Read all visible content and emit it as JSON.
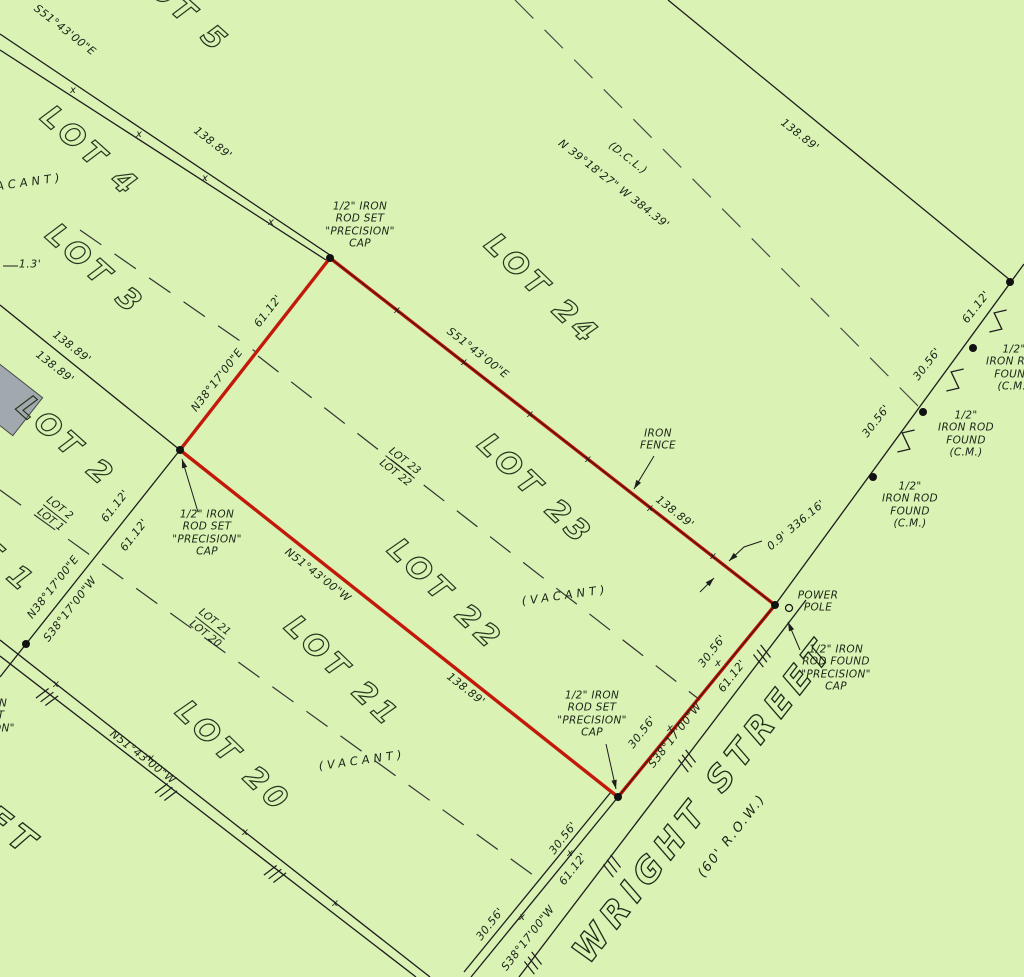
{
  "app": {
    "type": "survey-plat-drawing",
    "background_color": "#daf2b4",
    "line_color": "#1d1d1d",
    "red_color": "#c2190b",
    "building_fill": "#a2a9ae"
  },
  "parcel": {
    "description": "red outlined parcel covering LOT 22 and LOT 23",
    "outline_color": "#c2190b",
    "corners": [
      [
        330,
        258
      ],
      [
        775,
        605
      ],
      [
        618,
        797
      ],
      [
        180,
        450
      ]
    ]
  },
  "lot_labels_large": [
    {
      "text": "LOT 5",
      "x": 180,
      "y": 8,
      "rot": 42
    },
    {
      "text": "LOT 4",
      "x": 90,
      "y": 152,
      "rot": 42
    },
    {
      "text": "LOT 3",
      "x": 95,
      "y": 270,
      "rot": 42
    },
    {
      "text": "LOT 2",
      "x": 66,
      "y": 442,
      "rot": 42
    },
    {
      "text": "LOT 1",
      "x": -14,
      "y": 548,
      "rot": 42
    },
    {
      "text": "LOT 24",
      "x": 542,
      "y": 290,
      "rot": 44
    },
    {
      "text": "LOT 23",
      "x": 535,
      "y": 490,
      "rot": 44
    },
    {
      "text": "LOT 22",
      "x": 445,
      "y": 595,
      "rot": 44
    },
    {
      "text": "LOT 21",
      "x": 342,
      "y": 672,
      "rot": 44
    },
    {
      "text": "LOT 20",
      "x": 233,
      "y": 757,
      "rot": 44
    }
  ],
  "street_labels": [
    {
      "text": "WRIGHT  STREET",
      "x": 704,
      "y": 800,
      "rot": -52,
      "cls": "street"
    },
    {
      "text": "(60' R.O.W.)",
      "x": 732,
      "y": 836,
      "rot": -52,
      "cls": "row"
    },
    {
      "text": "FT",
      "x": 12,
      "y": 832,
      "rot": 38,
      "cls": "street"
    }
  ],
  "vacant_labels": [
    {
      "text": "(VACANT)",
      "x": 20,
      "y": 183,
      "rot": -8
    },
    {
      "text": "(VACANT)",
      "x": 565,
      "y": 595,
      "rot": -8
    },
    {
      "text": "(VACANT)",
      "x": 362,
      "y": 760,
      "rot": -8
    }
  ],
  "lot_fraction_labels": [
    {
      "top": "LOT 23",
      "bottom": "LOT 22",
      "x": 400,
      "y": 467,
      "rot": 38
    },
    {
      "top": "LOT 21",
      "bottom": "LOT 20",
      "x": 210,
      "y": 628,
      "rot": 38
    },
    {
      "top": "LOT 2",
      "bottom": "LOT 1",
      "x": 55,
      "y": 514,
      "rot": 38
    }
  ],
  "dimension_labels": [
    {
      "text": "S51°43'00\"E",
      "x": 65,
      "y": 30,
      "rot": 38
    },
    {
      "text": "138.89'",
      "x": 213,
      "y": 143,
      "rot": 38
    },
    {
      "text": "S51°43'00\"E",
      "x": 478,
      "y": 353,
      "rot": 38
    },
    {
      "text": "138.89'",
      "x": 675,
      "y": 512,
      "rot": 38
    },
    {
      "text": "138.89'",
      "x": 800,
      "y": 135,
      "rot": 38
    },
    {
      "text": "138.89'",
      "x": 72,
      "y": 347,
      "rot": 38
    },
    {
      "text": "138.89'",
      "x": 55,
      "y": 367,
      "rot": 38
    },
    {
      "text": "N51°43'00\"W",
      "x": 318,
      "y": 575,
      "rot": 38
    },
    {
      "text": "138.89'",
      "x": 466,
      "y": 689,
      "rot": 38
    },
    {
      "text": "N51°43'00\"W",
      "x": 143,
      "y": 757,
      "rot": 38
    },
    {
      "text": "(D.C.L.)",
      "x": 628,
      "y": 158,
      "rot": 38
    },
    {
      "text": "N 39°18'27\" W  384.39'",
      "x": 614,
      "y": 184,
      "rot": 38
    },
    {
      "text": "N38°17'00\"E",
      "x": 217,
      "y": 380,
      "rot": -52
    },
    {
      "text": "61.12'",
      "x": 268,
      "y": 311,
      "rot": -52
    },
    {
      "text": "61.12'",
      "x": 115,
      "y": 506,
      "rot": -52
    },
    {
      "text": "61.12'",
      "x": 134,
      "y": 535,
      "rot": -52
    },
    {
      "text": "N38°17'00\"E",
      "x": 53,
      "y": 587,
      "rot": -52
    },
    {
      "text": "S38°17'00\"W",
      "x": 70,
      "y": 609,
      "rot": -52
    },
    {
      "text": "30.56'",
      "x": 712,
      "y": 651,
      "rot": -52
    },
    {
      "text": "61.12'",
      "x": 732,
      "y": 676,
      "rot": -52
    },
    {
      "text": "S38°17'00\"W",
      "x": 675,
      "y": 735,
      "rot": -52
    },
    {
      "text": "30.56'",
      "x": 642,
      "y": 732,
      "rot": -52
    },
    {
      "text": "30.56'",
      "x": 563,
      "y": 838,
      "rot": -52
    },
    {
      "text": "61.12'",
      "x": 573,
      "y": 869,
      "rot": -52
    },
    {
      "text": "30.56'",
      "x": 490,
      "y": 924,
      "rot": -52
    },
    {
      "text": "S38°17'00\"W",
      "x": 528,
      "y": 938,
      "rot": -52
    },
    {
      "text": "30.56'",
      "x": 876,
      "y": 421,
      "rot": -52
    },
    {
      "text": "30.56'",
      "x": 927,
      "y": 364,
      "rot": -52
    },
    {
      "text": "61.12'",
      "x": 976,
      "y": 307,
      "rot": -52
    },
    {
      "text": "0.9' 336.16'",
      "x": 796,
      "y": 525,
      "rot": -40
    },
    {
      "text": "1.3'",
      "x": 30,
      "y": 264,
      "rot": 0
    }
  ],
  "note_blocks": [
    {
      "name": "iron-rod-set-top",
      "lines": [
        "1/2\" IRON",
        "ROD SET",
        "\"PRECISION\"",
        "CAP"
      ],
      "x": 360,
      "y": 225
    },
    {
      "name": "iron-rod-set-left",
      "lines": [
        "1/2\" IRON",
        "ROD SET",
        "\"PRECISION\"",
        "CAP"
      ],
      "x": 207,
      "y": 533
    },
    {
      "name": "iron-rod-set-bottom",
      "lines": [
        "1/2\" IRON",
        "ROD SET",
        "\"PRECISION\"",
        "CAP"
      ],
      "x": 592,
      "y": 714
    },
    {
      "name": "iron-rod-set-edge",
      "lines": [
        "1/2\" IRON",
        "ROD SET",
        "\"PRECISION\"",
        "CAP"
      ],
      "x": -20,
      "y": 722
    },
    {
      "name": "iron-rod-found-pole",
      "lines": [
        "1/2\" IRON",
        "ROD FOUND",
        "\"PRECISION\"",
        "CAP"
      ],
      "x": 836,
      "y": 668
    },
    {
      "name": "iron-rod-found-1",
      "lines": [
        "1/2\"",
        "IRON ROD",
        "FOUND",
        "(C.M.)"
      ],
      "x": 910,
      "y": 505
    },
    {
      "name": "iron-rod-found-2",
      "lines": [
        "1/2\"",
        "IRON ROD",
        "FOUND",
        "(C.M.)"
      ],
      "x": 966,
      "y": 434
    },
    {
      "name": "iron-rod-found-3",
      "lines": [
        "1/2\"",
        "IRON ROD",
        "FOUND",
        "(C.M.)"
      ],
      "x": 1014,
      "y": 368
    },
    {
      "name": "power-pole",
      "lines": [
        "POWER",
        "POLE"
      ],
      "x": 818,
      "y": 602
    },
    {
      "name": "iron-fence",
      "lines": [
        "IRON",
        "FENCE"
      ],
      "x": 658,
      "y": 440
    }
  ],
  "geometry": {
    "solid_lines": [
      {
        "name": "lot5-lot4-fence-a",
        "pts": [
          [
            0,
            34
          ],
          [
            330,
            255
          ]
        ]
      },
      {
        "name": "lot5-lot4-fence-b",
        "pts": [
          [
            0,
            50
          ],
          [
            326,
            260
          ]
        ]
      },
      {
        "name": "lot3-lot2-line",
        "pts": [
          [
            0,
            305
          ],
          [
            180,
            450
          ]
        ]
      },
      {
        "name": "lot24-lot25-line",
        "pts": [
          [
            668,
            0
          ],
          [
            1010,
            280
          ]
        ]
      },
      {
        "name": "street-row-line-ne",
        "pts": [
          [
            775,
            605
          ],
          [
            1024,
            264
          ]
        ]
      },
      {
        "name": "street-row-line-sw-a",
        "pts": [
          [
            618,
            797
          ],
          [
            471,
            977
          ]
        ]
      },
      {
        "name": "street-row-line-sw-b",
        "pts": [
          [
            611,
            792
          ],
          [
            464,
            972
          ]
        ]
      },
      {
        "name": "street-edge-line",
        "pts": [
          [
            806,
            600
          ],
          [
            519,
            977
          ]
        ]
      },
      {
        "name": "rear-lot-line-sw",
        "pts": [
          [
            180,
            450
          ],
          [
            26,
            644
          ],
          [
            0,
            677
          ]
        ]
      },
      {
        "name": "block-end-fence-a",
        "pts": [
          [
            0,
            640
          ],
          [
            430,
            977
          ]
        ]
      },
      {
        "name": "block-end-fence-b",
        "pts": [
          [
            0,
            656
          ],
          [
            416,
            977
          ]
        ]
      }
    ],
    "dashed_lines": [
      {
        "name": "lot4-lot3-dashed",
        "pts": [
          [
            80,
            230
          ],
          [
            256,
            352
          ]
        ],
        "color": "#333333"
      },
      {
        "name": "lot23-lot22-dashed",
        "pts": [
          [
            258,
            356
          ],
          [
            700,
            700
          ]
        ],
        "color": "#333333"
      },
      {
        "name": "lot2-lot1-lot21-lot20-dashed",
        "pts": [
          [
            0,
            490
          ],
          [
            540,
            880
          ]
        ],
        "color": "#333333"
      },
      {
        "name": "deed-call-line-dashed",
        "pts": [
          [
            515,
            0
          ],
          [
            924,
            412
          ]
        ],
        "color": "#4a4a4a"
      }
    ],
    "fence_overlays": [
      {
        "name": "parcel-ne-fence",
        "pts": [
          [
            330,
            258
          ],
          [
            775,
            605
          ]
        ]
      },
      {
        "name": "parcel-se-fence",
        "pts": [
          [
            775,
            605
          ],
          [
            618,
            797
          ]
        ]
      }
    ],
    "fence_xticks": [
      [
        73,
        90
      ],
      [
        139,
        134
      ],
      [
        205,
        178
      ],
      [
        271,
        222
      ],
      [
        397,
        310
      ],
      [
        464,
        362
      ],
      [
        530,
        414
      ],
      [
        588,
        459
      ],
      [
        650,
        508
      ],
      [
        713,
        556
      ],
      [
        718,
        663
      ],
      [
        670,
        728
      ],
      [
        570,
        853
      ],
      [
        522,
        917
      ],
      [
        56,
        684
      ],
      [
        151,
        758
      ],
      [
        245,
        832
      ],
      [
        335,
        903
      ]
    ],
    "dots": [
      [
        330,
        258
      ],
      [
        180,
        450
      ],
      [
        618,
        797
      ],
      [
        775,
        605
      ],
      [
        873,
        477
      ],
      [
        923,
        412
      ],
      [
        973,
        348
      ],
      [
        1010,
        282
      ],
      [
        26,
        644
      ]
    ],
    "pole_circle": {
      "x": 789,
      "y": 608,
      "r": 3.5
    },
    "zigzag_breaks": [
      [
        906,
        441
      ],
      [
        955,
        380
      ],
      [
        998,
        321
      ]
    ],
    "witness_hashes": [
      {
        "x": 47,
        "y": 697,
        "a": 38
      },
      {
        "x": 166,
        "y": 792,
        "a": 38
      },
      {
        "x": 275,
        "y": 874,
        "a": 38
      },
      {
        "x": 612,
        "y": 866,
        "a": -53
      },
      {
        "x": 687,
        "y": 761,
        "a": -53
      },
      {
        "x": 533,
        "y": 963,
        "a": -53
      },
      {
        "x": 762,
        "y": 656,
        "a": -53
      }
    ],
    "leaders": [
      {
        "name": "iron-fence-leader",
        "pts": [
          [
            654,
            456
          ],
          [
            634,
            489
          ]
        ],
        "arrow": true
      },
      {
        "name": "offset-dim-leader-a",
        "pts": [
          [
            762,
            541
          ],
          [
            744,
            547
          ],
          [
            729,
            561
          ]
        ],
        "arrow": true
      },
      {
        "name": "offset-dim-leader-b",
        "pts": [
          [
            700,
            592
          ],
          [
            714,
            578
          ]
        ],
        "arrow": true
      },
      {
        "name": "pole-rod-leader",
        "pts": [
          [
            800,
            650
          ],
          [
            788,
            622
          ]
        ],
        "arrow": true
      },
      {
        "name": "bottom-rod-leader",
        "pts": [
          [
            606,
            744
          ],
          [
            616,
            789
          ]
        ],
        "arrow": true
      },
      {
        "name": "left-rod-leader",
        "pts": [
          [
            198,
            512
          ],
          [
            182,
            459
          ]
        ],
        "arrow": true
      },
      {
        "name": "offset-1-3-leader",
        "pts": [
          [
            3,
            266
          ],
          [
            18,
            266
          ]
        ],
        "arrow": false
      }
    ],
    "building_polygon": [
      [
        -42.6,
        392.3
      ],
      [
        -12.8,
        354.3
      ],
      [
        42.6,
        397.7
      ],
      [
        12.8,
        435.7
      ]
    ]
  }
}
